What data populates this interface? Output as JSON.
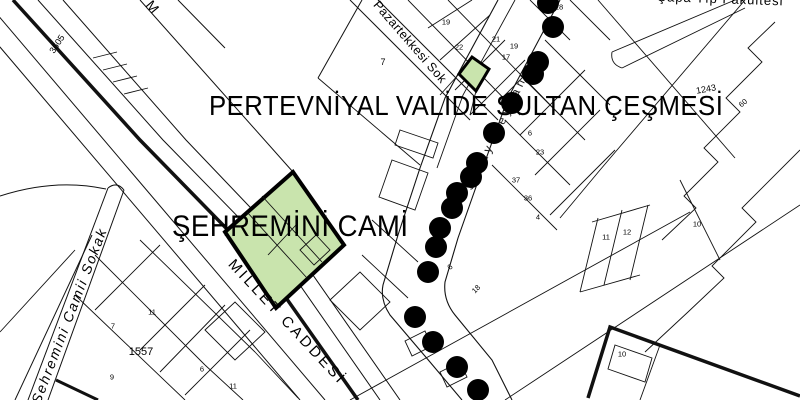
{
  "map": {
    "monument_labels": [
      {
        "text": "PERTEVNİYAL VALİDE SULTAN ÇEŞMESİ"
      },
      {
        "text": "ŞEHREMİNİ CAMİ"
      }
    ],
    "street_labels": [
      {
        "text": "MİLLET CADDESİ"
      },
      {
        "text": "Pazartekkesi Sok"
      },
      {
        "text": "Şehremini Camii Sokak"
      },
      {
        "text": "Saray Meydanı"
      },
      {
        "text": "Çapa Tıp Fakültesi"
      },
      {
        "text": "M"
      }
    ],
    "parcel_numbers": [
      {
        "text": "3605",
        "x": 57,
        "y": 44,
        "rot": -57,
        "size": 9
      },
      {
        "text": "7",
        "x": 383,
        "y": 62,
        "size": 9
      },
      {
        "text": "19",
        "x": 446,
        "y": 22
      },
      {
        "text": "22",
        "x": 459,
        "y": 47
      },
      {
        "text": "21",
        "x": 496,
        "y": 39
      },
      {
        "text": "19",
        "x": 514,
        "y": 46
      },
      {
        "text": "17",
        "x": 506,
        "y": 57
      },
      {
        "text": "18",
        "x": 559,
        "y": 7
      },
      {
        "text": "6",
        "x": 530,
        "y": 133
      },
      {
        "text": "23",
        "x": 540,
        "y": 152
      },
      {
        "text": "37",
        "x": 516,
        "y": 180
      },
      {
        "text": "36",
        "x": 528,
        "y": 198
      },
      {
        "text": "4",
        "x": 538,
        "y": 217
      },
      {
        "text": "6",
        "x": 450,
        "y": 267,
        "rot": -45
      },
      {
        "text": "18",
        "x": 476,
        "y": 289,
        "rot": -45
      },
      {
        "text": "11",
        "x": 152,
        "y": 312
      },
      {
        "text": "7",
        "x": 113,
        "y": 326
      },
      {
        "text": "1557",
        "x": 141,
        "y": 352,
        "size": 11
      },
      {
        "text": "9",
        "x": 112,
        "y": 377
      },
      {
        "text": "6",
        "x": 202,
        "y": 369
      },
      {
        "text": "11",
        "x": 233,
        "y": 386
      },
      {
        "text": "11",
        "x": 606,
        "y": 237
      },
      {
        "text": "12",
        "x": 627,
        "y": 232
      },
      {
        "text": "10",
        "x": 697,
        "y": 224
      },
      {
        "text": "10",
        "x": 622,
        "y": 354
      },
      {
        "text": "1243",
        "x": 706,
        "y": 89,
        "rot": -10,
        "size": 9
      },
      {
        "text": "60",
        "x": 743,
        "y": 103,
        "rot": -40
      }
    ],
    "trees": [
      [
        548,
        3
      ],
      [
        553,
        27
      ],
      [
        538,
        62
      ],
      [
        533,
        74
      ],
      [
        512,
        103
      ],
      [
        494,
        133
      ],
      [
        477,
        163
      ],
      [
        471,
        177
      ],
      [
        457,
        193
      ],
      [
        452,
        208
      ],
      [
        440,
        228
      ],
      [
        436,
        247
      ],
      [
        428,
        272
      ],
      [
        415,
        317
      ],
      [
        433,
        342
      ],
      [
        457,
        367
      ],
      [
        478,
        390
      ]
    ],
    "colors": {
      "line": "#111111",
      "monument_fill": "#c9e4ad",
      "tree": "#000000",
      "background": "#ffffff"
    }
  }
}
